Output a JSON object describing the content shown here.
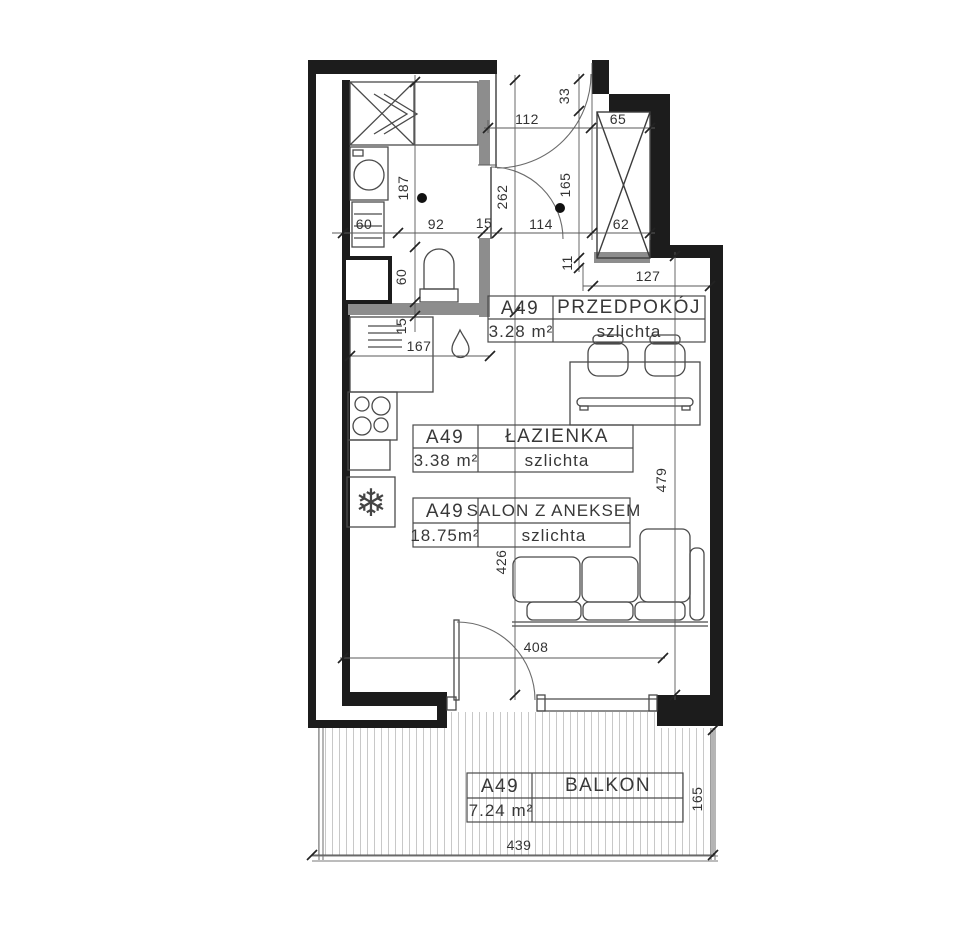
{
  "rooms": [
    {
      "code": "A49",
      "name": "PRZEDPOKÓJ",
      "area": "3.28 m²",
      "finish": "szlichta"
    },
    {
      "code": "A49",
      "name": "ŁAZIENKA",
      "area": "3.38 m²",
      "finish": "szlichta"
    },
    {
      "code": "A49",
      "name": "SALON Z ANEKSEM",
      "area": "18.75m²",
      "finish": "szlichta"
    },
    {
      "code": "A49",
      "name": "BALKON",
      "area": "7.24 m²",
      "finish": ""
    }
  ],
  "dims": {
    "d112": "112",
    "d33": "33",
    "d65": "65",
    "d187": "187",
    "d262": "262",
    "d165_entry": "165",
    "d60_wm": "60",
    "d92": "92",
    "d15_door": "15",
    "d114": "114",
    "d62": "62",
    "d11": "11",
    "d127": "127",
    "d60_wc": "60",
    "d15_wall": "15",
    "d167": "167",
    "d479": "479",
    "d426": "426",
    "d408": "408",
    "d439": "439",
    "d165_balcony": "165"
  },
  "icons": {
    "fridge": "❄"
  },
  "colors": {
    "wall": "#1c1c1c",
    "partition": "#8d8d8d",
    "hatch": "#c8c8c8",
    "text": "#383838"
  }
}
